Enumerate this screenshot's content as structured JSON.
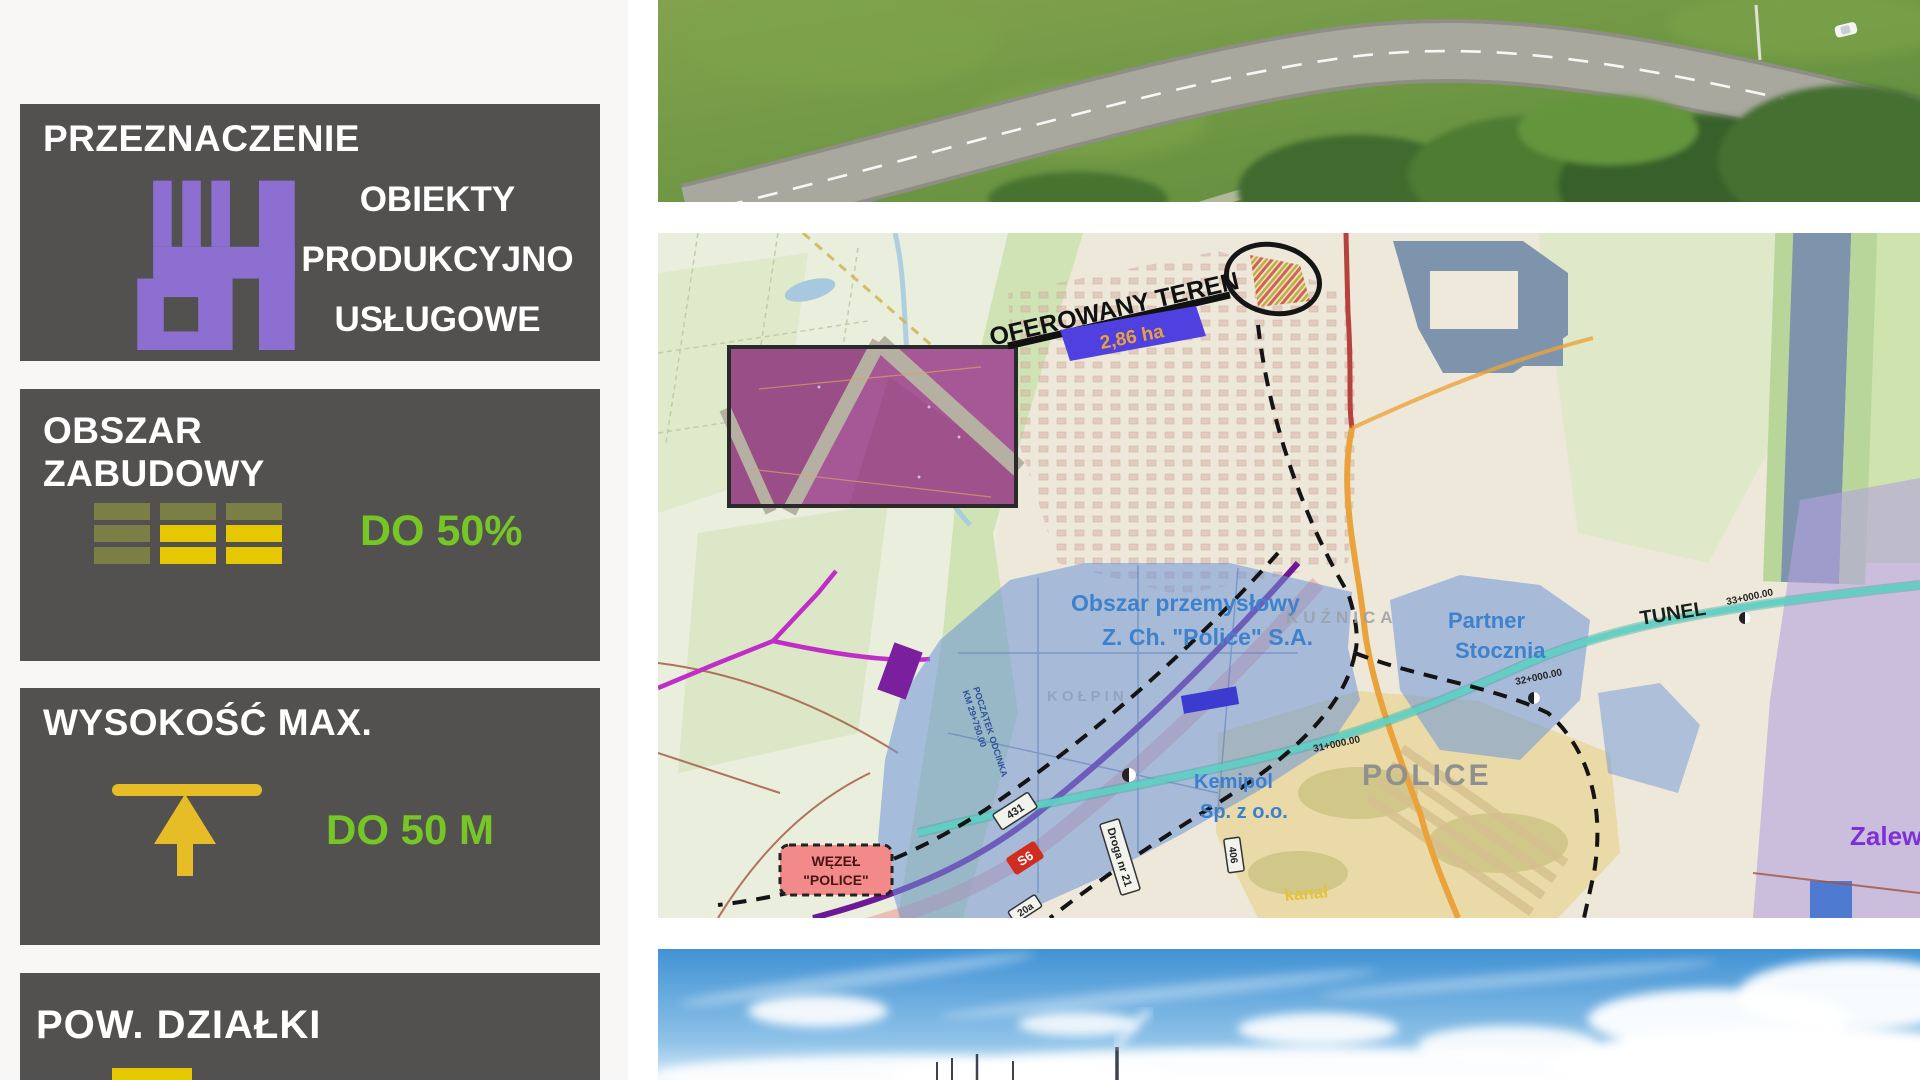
{
  "sidebar": {
    "panel_bg": "#535150",
    "accent_green": "#76c626",
    "panels": [
      {
        "title": "PRZEZNACZENIE",
        "icon": "factory-icon",
        "icon_color": "#8d6fd2",
        "value_lines": [
          "OBIEKTY",
          "PRODUKCYJNO",
          "USŁUGOWE"
        ]
      },
      {
        "title_line1": "OBSZAR",
        "title_line2": "ZABUDOWY",
        "icon": "coverage-bars-icon",
        "olive": "#7c7f45",
        "yellow": "#e5c702",
        "value": "DO 50%"
      },
      {
        "title": "WYSOKOŚĆ MAX.",
        "icon": "height-limit-arrow-icon",
        "icon_color": "#e7bd27",
        "value": "DO 50 M"
      },
      {
        "title": "POW. DZIAŁKI",
        "icon": "plot-area-icon",
        "icon_color": "#e5c702"
      }
    ]
  },
  "photos": {
    "top": "aerial-road-photo",
    "bottom": "sky-clouds-photo"
  },
  "map": {
    "callout": {
      "label": "OFEROWANY TEREN",
      "area": "2,86 ha"
    },
    "labels": {
      "industrial1": "Obszar przemysłowy",
      "industrial2": "Z. Ch. \"Police\" S.A.",
      "kuznica": "KUŹNICA",
      "kolpin": "KOŁPIN",
      "partner1": "Partner",
      "partner2": "Stocznia",
      "tunel": "TUNEL",
      "km33": "33+000.00",
      "km32": "32+000.00",
      "km31": "31+000.00",
      "police": "POLICE",
      "kemipol1": "Kemipol",
      "kemipol2": "Sp. z o.o.",
      "wezel1": "WĘZEŁ",
      "wezel2": "\"POLICE\"",
      "zalew": "Zalew",
      "s6": "S6",
      "r431": "431",
      "droga": "Droga nr 21",
      "r406": "406",
      "r20a": "20a",
      "kanal": "kanał",
      "start1": "POCZĄTEK ODCINKA",
      "start2": "KM 29+750.00"
    }
  }
}
